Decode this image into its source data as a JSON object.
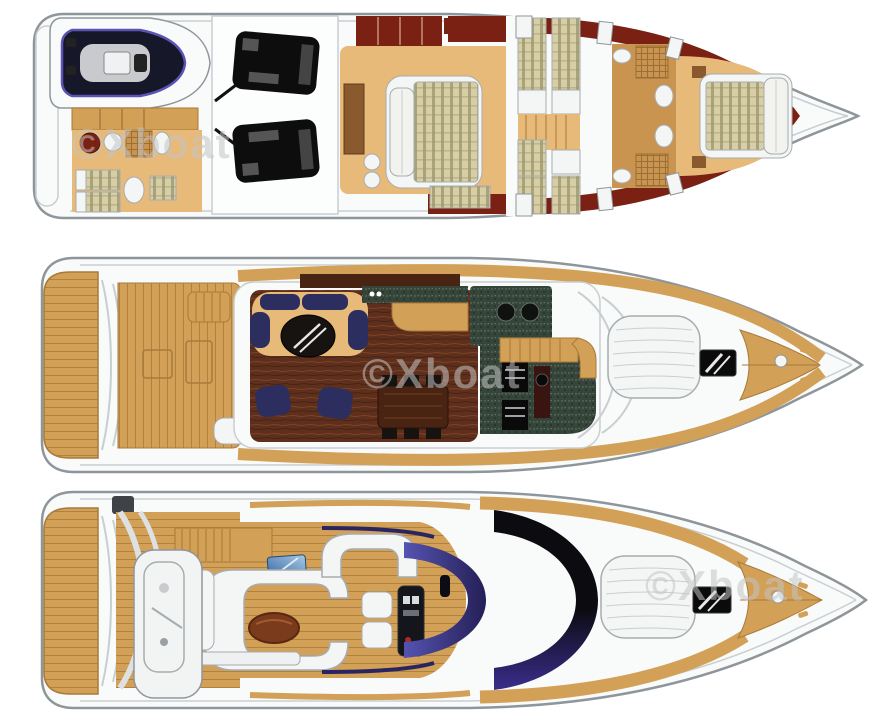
{
  "page": {
    "background": "#ffffff"
  },
  "watermark": {
    "text": "©Xboat"
  },
  "palette": {
    "background": "#ffffff",
    "hull": "#f9fafa",
    "hull_line": "#8f969b",
    "hull_inner": "#c9ced1",
    "teak": "#d2a057",
    "teak_line": "#a87a3a",
    "wood": "#e7ba79",
    "wood_dark": "#8a5a2e",
    "wood_mid": "#c99350",
    "maroon": "#7a2113",
    "navy": "#2b2e5e",
    "saloon_floor": "#5d2f1c",
    "saloon_streak": "#8a4a28",
    "granite": "#36453a",
    "engine": "#0d0d0d",
    "mattress": "#d7cea6",
    "mattress_stripe": "#9e9870",
    "glass_indigo_light": "#5553b2",
    "glass_indigo_mid": "#3a2d8c",
    "glass_indigo_dark": "#241f55",
    "glass_black": "#0b0b10",
    "blue_light": "#a6c9e6",
    "blue_dark": "#2e5e9e",
    "table_black": "#171310",
    "dining_wood": "#4a2413",
    "fly_table_wood": "#7a3a1c",
    "white_furn": "#f4f6f5",
    "furn_line": "#a6acb0",
    "console_dark": "#14161c",
    "helm_dash": "#3a1410",
    "tender_hull": "#17172a",
    "tender_trim": "#5a54b4",
    "watermark": "#c4c4c4"
  },
  "decks": [
    {
      "id": "lower-deck",
      "features": [
        "tender-garage",
        "crew-cabin",
        "engine-room",
        "master-cabin",
        "twin-cabins",
        "bathrooms",
        "vip-cabin"
      ]
    },
    {
      "id": "main-deck",
      "features": [
        "swim-platform",
        "aft-cockpit",
        "saloon",
        "galley",
        "dining-area",
        "stairway",
        "foredeck-sunpad",
        "anchor-hatch"
      ]
    },
    {
      "id": "flybridge",
      "features": [
        "swim-platform",
        "tender-crane",
        "wet-bar",
        "u-sofa",
        "helm-seats",
        "helm-console",
        "windscreen",
        "foredeck-sunpad"
      ]
    }
  ]
}
